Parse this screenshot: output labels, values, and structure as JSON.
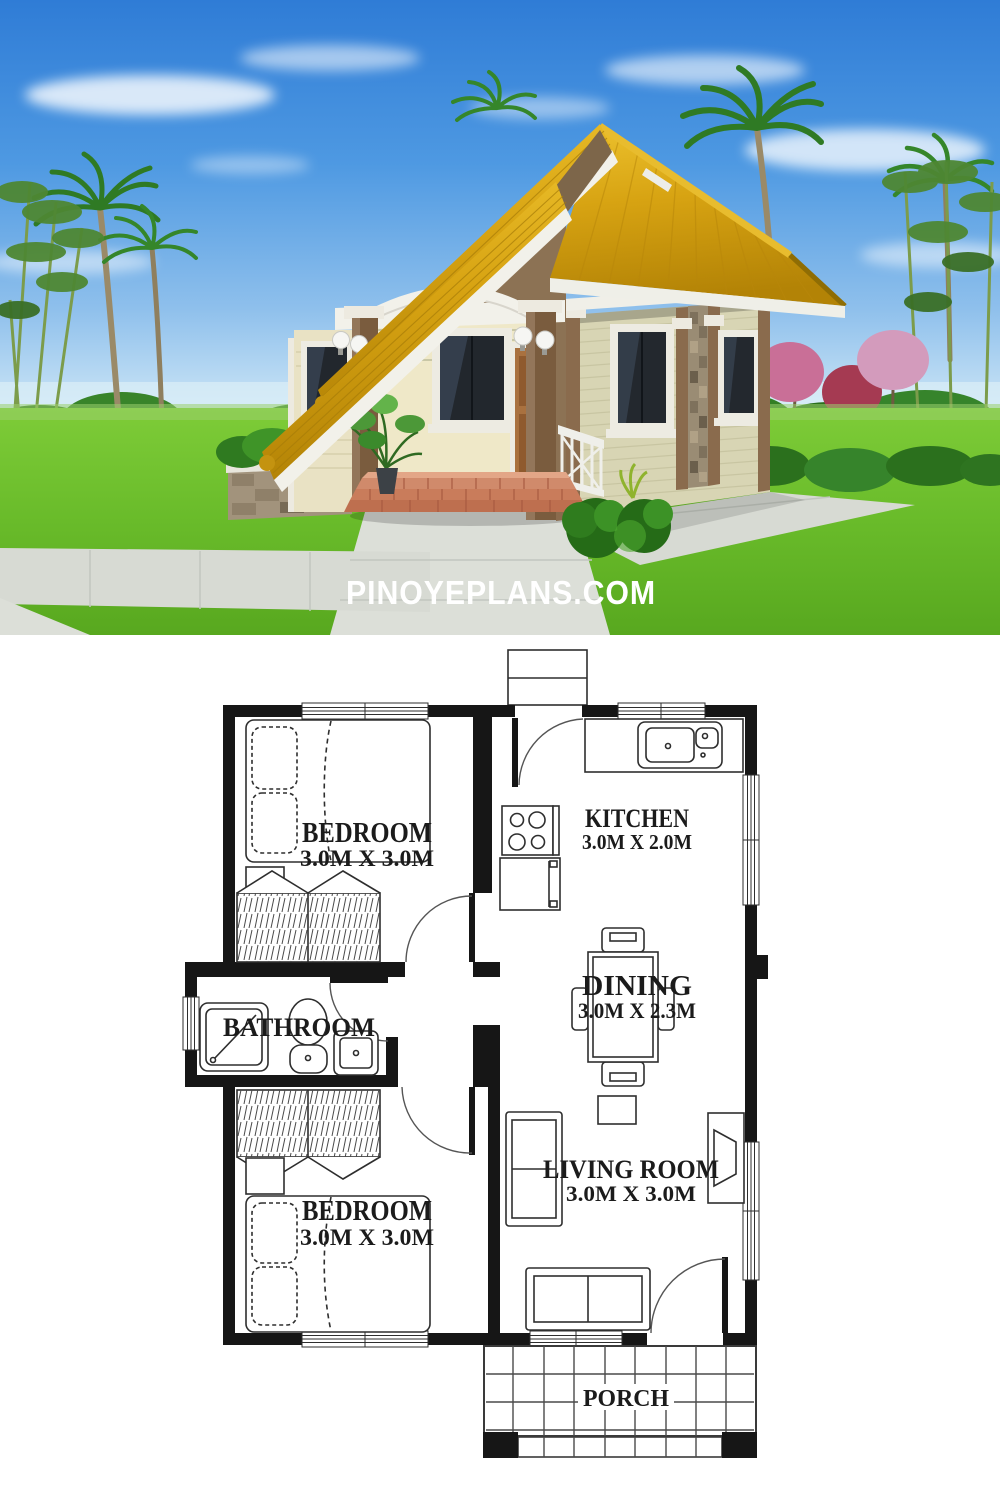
{
  "watermark": {
    "text": "PINOYEPLANS.COM"
  },
  "floor_plan": {
    "rooms": {
      "bedroom_top": {
        "label": "BEDROOM",
        "size": "3.0M X 3.0M"
      },
      "kitchen": {
        "label": "KITCHEN",
        "size": "3.0M X 2.0M"
      },
      "dining": {
        "label": "DINING",
        "size": "3.0M X 2.3M"
      },
      "bathroom": {
        "label": "BATHROOM"
      },
      "living_room": {
        "label": "LIVING ROOM",
        "size": "3.0M X 3.0M"
      },
      "bedroom_bottom": {
        "label": "BEDROOM",
        "size": "3.0M X 3.0M"
      },
      "porch": {
        "label": "PORCH"
      }
    }
  },
  "colors": {
    "sky_blue": "#3B87DB",
    "grass_green": "#5FAE22",
    "roof_gold": "#D7A312",
    "wall_cream": "#E9E2C4",
    "wall_sage": "#D8D5B4",
    "trim_white": "#F2F1EA",
    "accent_brown": "#8A6B4D",
    "brick_step": "#CC7C5F",
    "plan_wall": "#161616"
  }
}
